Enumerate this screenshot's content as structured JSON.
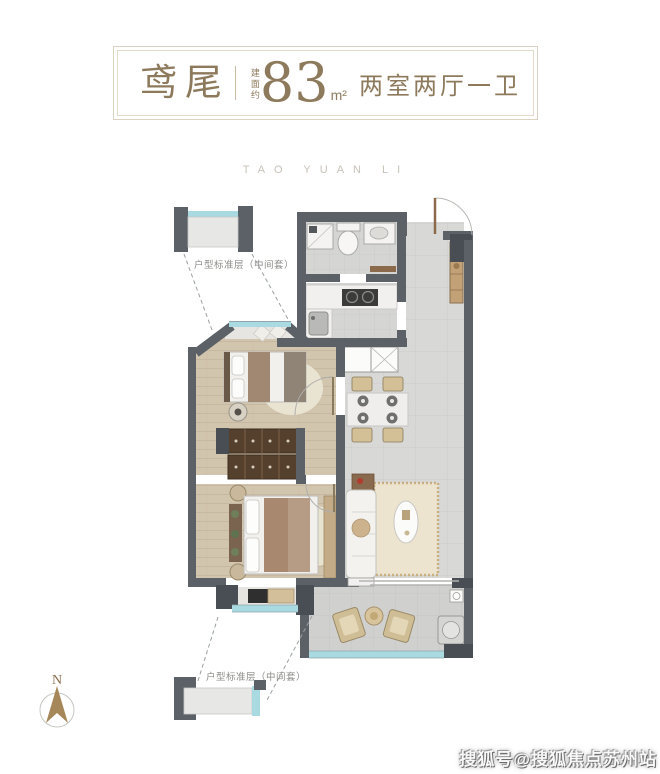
{
  "title": {
    "name": "鸢尾",
    "area_label": "建面约",
    "area_value": "83",
    "area_unit": "m²",
    "rooms": "两室两厅一卫"
  },
  "project_name": "TAO YUAN LI",
  "plan": {
    "annotation_top": "户型标准层（中间套）",
    "annotation_bottom": "户型标准层（中间套）"
  },
  "compass": {
    "label": "N"
  },
  "watermark": {
    "text": "搜狐号@搜狐焦点苏州站"
  },
  "colors": {
    "title_text": "#8d7a5c",
    "frame_border": "#dcd2c1",
    "wall": "#5b6166",
    "wall_dark": "#484e53",
    "glazing": "#a9dae1",
    "wood_floor": "#d2c5ae",
    "tile_floor": "#d8d9d7",
    "annotation_text": "#8b8b88",
    "compass_arrow": "#a6875a"
  }
}
